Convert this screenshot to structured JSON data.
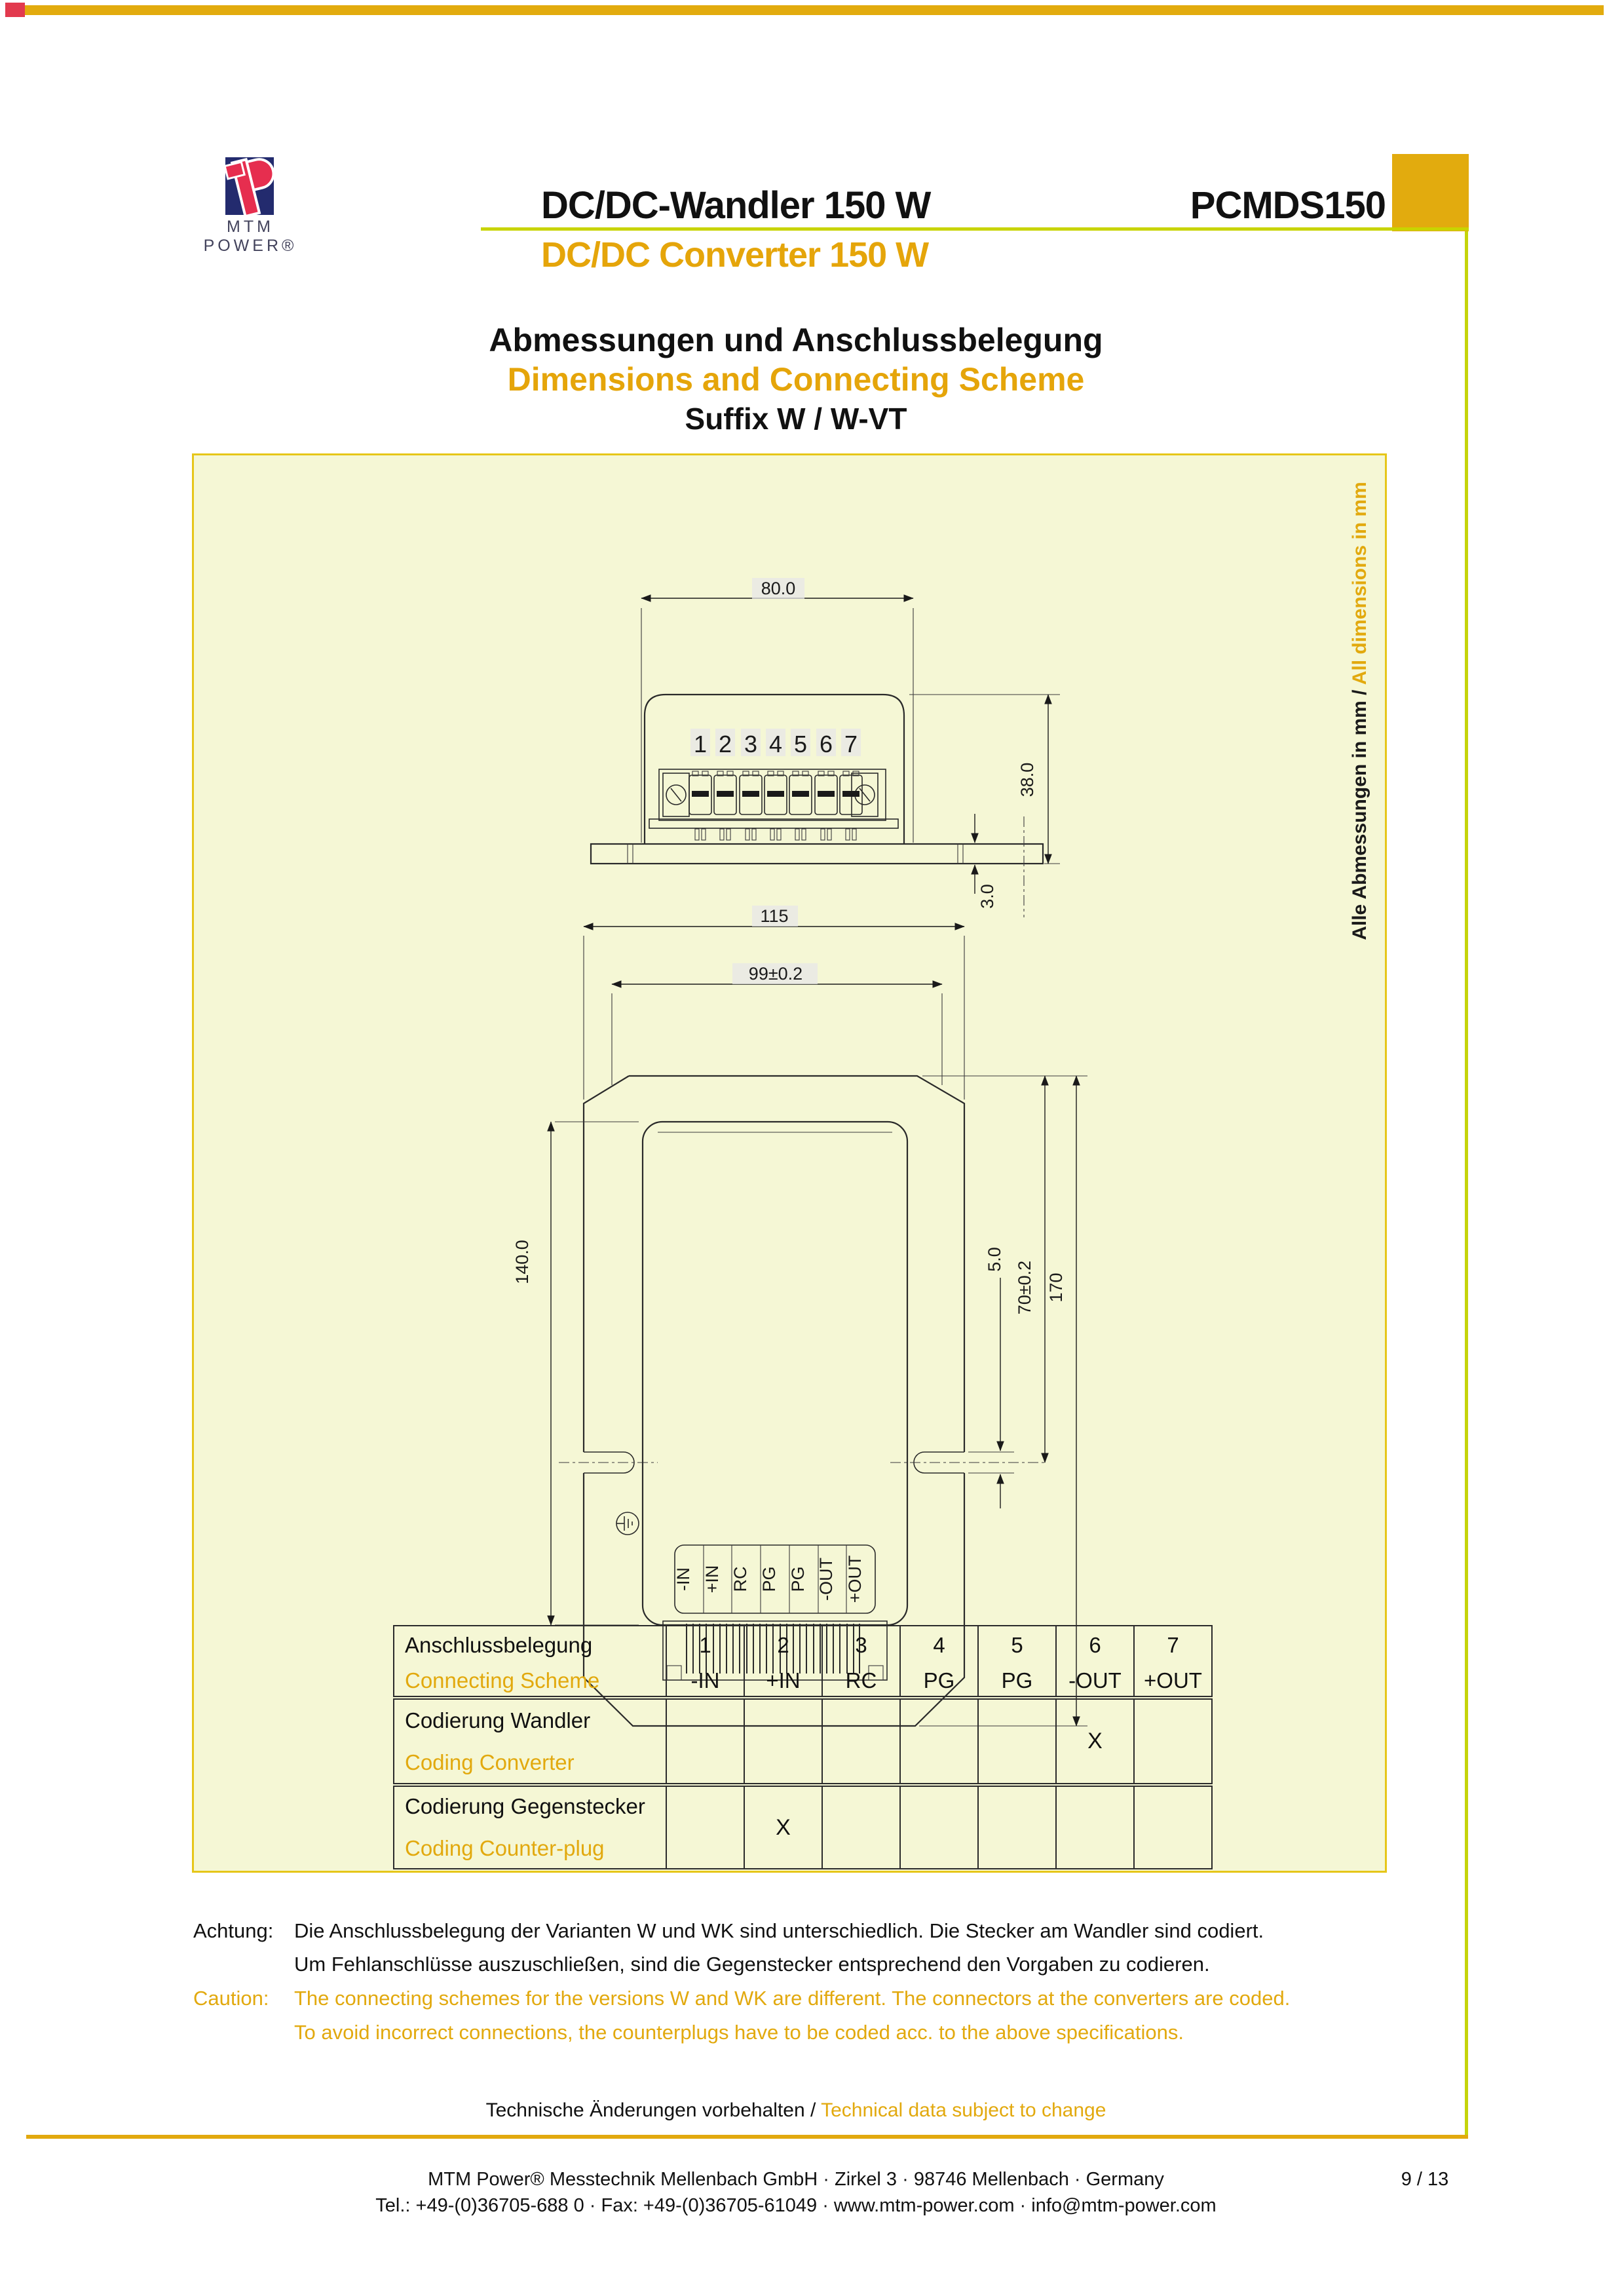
{
  "frame": {
    "accent_gold": "#e2ab0e",
    "accent_chartreuse": "#c5d40b",
    "accent_red": "#e23a4e"
  },
  "header": {
    "brand": "MTM POWER®",
    "title_de": "DC/DC-Wandler 150 W",
    "title_en": "DC/DC Converter 150 W",
    "model": "PCMDS150"
  },
  "section": {
    "heading_de": "Abmessungen und Anschlussbelegung",
    "heading_en": "Dimensions and Connecting Scheme",
    "suffix": "Suffix W / W-VT"
  },
  "drawing": {
    "units_note_de": "Alle Abmessungen in mm / ",
    "units_note_en": "All dimensions in mm",
    "front": {
      "pins": [
        "1",
        "2",
        "3",
        "4",
        "5",
        "6",
        "7"
      ],
      "dim_width": "80.0",
      "dim_height": "38.0",
      "dim_plate": "3.0"
    },
    "plan": {
      "labels": [
        "-IN",
        "+IN",
        "RC",
        "PG",
        "PG",
        "-OUT",
        "+OUT"
      ],
      "dim_overall_w": "115",
      "dim_inner_w": "99±0.2",
      "dim_body_l": "140.0",
      "dim_slot": "5.0",
      "dim_notch": "70±0.2",
      "dim_overall_l": "170"
    }
  },
  "table": {
    "scheme": {
      "de": "Anschlussbelegung",
      "en": "Connecting Scheme",
      "cols": [
        {
          "n": "1",
          "v": "-IN"
        },
        {
          "n": "2",
          "v": "+IN"
        },
        {
          "n": "3",
          "v": "RC"
        },
        {
          "n": "4",
          "v": "PG"
        },
        {
          "n": "5",
          "v": "PG"
        },
        {
          "n": "6",
          "v": "-OUT"
        },
        {
          "n": "7",
          "v": "+OUT"
        }
      ]
    },
    "coding_converter": {
      "de": "Codierung Wandler",
      "en": "Coding Converter",
      "x": "X"
    },
    "coding_counterplug": {
      "de": "Codierung Gegenstecker",
      "en": "Coding Counter-plug",
      "x": "X"
    }
  },
  "caution": {
    "label_de": "Achtung:",
    "de1": "Die Anschlussbelegung der Varianten W und WK sind unterschiedlich. Die Stecker am Wandler sind codiert.",
    "de2": "Um Fehlanschlüsse auszuschließen, sind die Gegenstecker entsprechend den Vorgaben zu codieren.",
    "label_en": "Caution:",
    "en1": "The connecting schemes for the versions W and WK are different. The connectors at the converters are coded.",
    "en2": "To avoid incorrect connections, the counterplugs have to be coded acc. to the above specifications."
  },
  "footer": {
    "note_de": "Technische Änderungen vorbehalten / ",
    "note_en": "Technical data subject to change",
    "company": "MTM Power® Messtechnik Mellenbach GmbH · Zirkel 3 · 98746 Mellenbach · Germany",
    "contact": "Tel.: +49-(0)36705-688 0 · Fax: +49-(0)36705-61049 · www.mtm-power.com · info@mtm-power.com",
    "page": "9 / 13"
  }
}
